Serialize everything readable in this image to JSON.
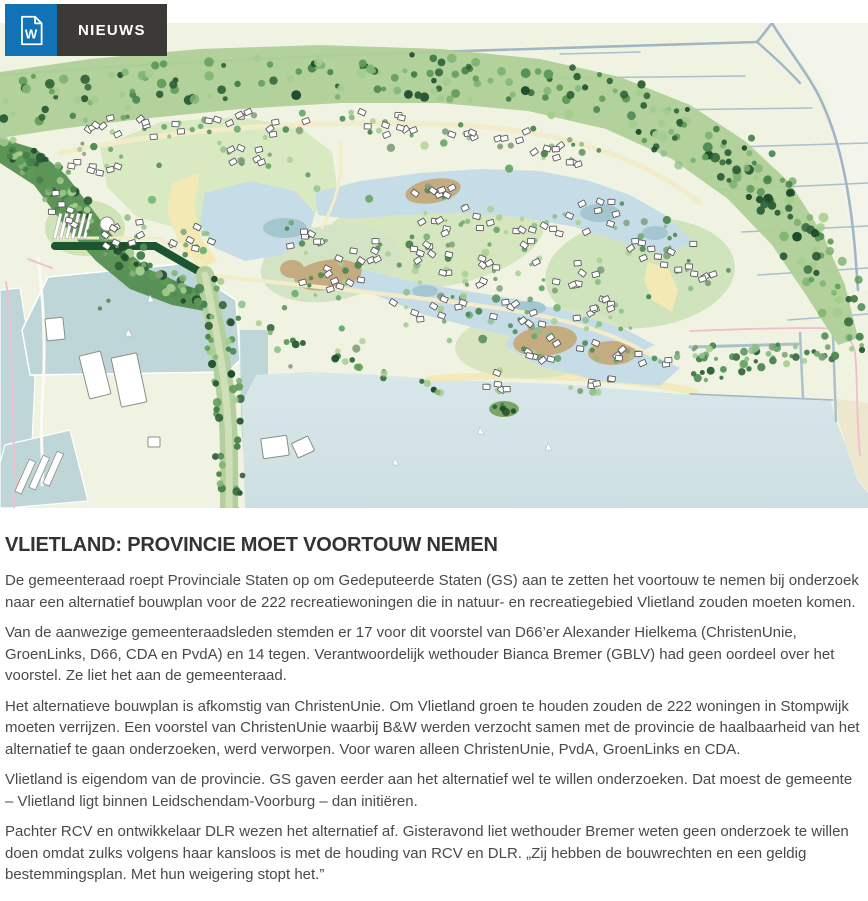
{
  "header": {
    "nav_label": "NIEUWS",
    "doc_icon_letter": "W",
    "colors": {
      "accent_blue": "#1173b5",
      "nav_charcoal": "#3b3a37"
    }
  },
  "article": {
    "title": "VLIETLAND: PROVINCIE MOET VOORTOUW NEMEN",
    "paragraphs": [
      "De gemeenteraad roept Provinciale Staten op om Gedeputeerde Staten (GS) aan te zetten het voortouw te nemen bij onderzoek naar een alternatief bouwplan voor de 222 recreatiewoningen die in natuur- en recreatiegebied Vlietland zouden moeten komen.",
      "Van de aanwezige gemeenteraadsleden stemden er 17 voor dit voorstel van D66’er Alexander Hielkema (ChristenUnie, GroenLinks, D66, CDA en PvdA) en 14 tegen. Verantwoordelijk wethouder Bianca Bremer (GBLV) had geen oordeel over het voorstel. Ze liet het aan de gemeenteraad.",
      "Het alternatieve bouwplan is afkomstig van ChristenUnie. Om Vlietland groen te houden zouden de 222 woningen in Stompwijk moeten verrijzen. Een voorstel van ChristenUnie waarbij B&W werden verzocht samen met de provincie de haalbaarheid van het alternatief te gaan onderzoeken, werd verworpen. Voor waren alleen ChristenUnie, PvdA, GroenLinks en CDA.",
      "Vlietland is eigendom van de provincie. GS gaven eerder aan het alternatief wel te willen onderzoeken. Dat moest de gemeente – Vlietland ligt binnen Leidschendam-Voorburg – dan initiëren.",
      "Pachter RCV en ontwikkelaar DLR wezen het alternatief af. Gisteravond liet wethouder Bremer weten geen onderzoek te willen doen omdat zulks volgens haar kansloos is met de houding van RCV en DLR. „Zij hebben de bouwrechten en een geldig bestemmingsplan. Met hun weigering stopt het.”"
    ]
  },
  "illustration": {
    "palette": {
      "land": "#f0f3e2",
      "land_light": "#f3f5ea",
      "wedge": "#ece7cd",
      "water": "#c6dde8",
      "basin": "#bfd6d8",
      "lake_top": "#d8e7e9",
      "lake_bottom": "#cedfe3",
      "deep": "#a4c6d0",
      "meadow": "#d9e9c2",
      "meadow2": "#cfe4b6",
      "belt_under": "#aecf97",
      "left_belt": "#4d8a49",
      "hedge_dark": "#1d5531",
      "beach": "#f2e9b4",
      "island": "#c4ab80",
      "island_green": "#7ba566",
      "road": "#9fb6c6",
      "line_blue": "#a9bfcd",
      "canal": "#a8c2cc",
      "path_cream": "#f3ecca",
      "path_pink": "#f0bece",
      "avenue": "#b3cf9e",
      "avenue_in": "#cfe0b8",
      "cabin_fill": "#ffffff",
      "cabin_stroke": "#5a5a5a",
      "forest_greens": [
        "#2d6137",
        "#44804a",
        "#5e9b57",
        "#7fb473",
        "#a3cd8e",
        "#1f4d2c"
      ],
      "resort_greens": [
        "#4e8a52",
        "#6aa96b",
        "#8cc08a",
        "#a9cf92",
        "#7f9d7a"
      ]
    }
  }
}
